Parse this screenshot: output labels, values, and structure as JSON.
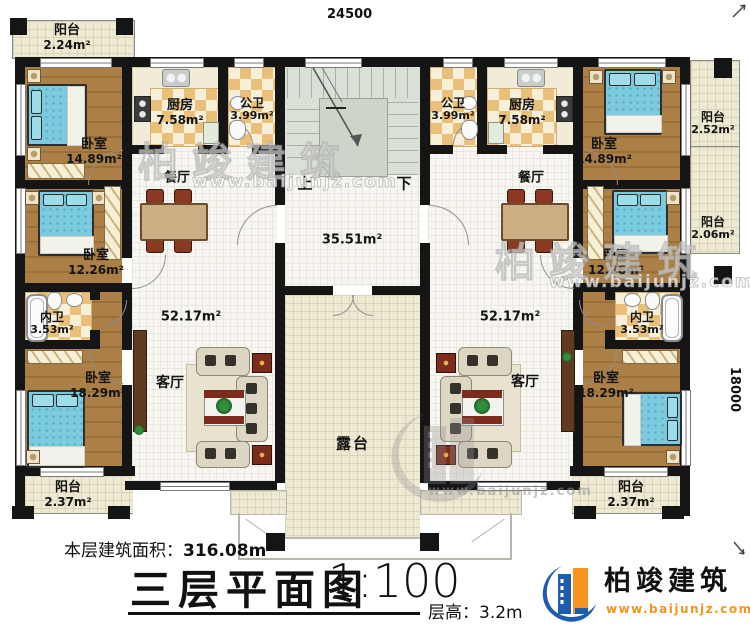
{
  "dims": {
    "top": "24500",
    "right": "18000"
  },
  "stairs": {
    "up": "上",
    "down": "下"
  },
  "rooms": {
    "tl_balcony": {
      "name": "阳台",
      "area": "2.24m²"
    },
    "l_bedroom1": {
      "name": "卧室",
      "area": "14.89m²"
    },
    "l_kitchen": {
      "name": "厨房",
      "area": "7.58m²"
    },
    "l_bath": {
      "name": "公卫",
      "area": "3.99m²"
    },
    "l_dining": {
      "name": "餐厅"
    },
    "l_bedroom2": {
      "name": "卧室",
      "area": "12.26m²"
    },
    "l_wc": {
      "name": "内卫",
      "area": "3.53m²"
    },
    "l_bedroom3": {
      "name": "卧室",
      "area": "18.29m²"
    },
    "l_living": {
      "name": "客厅",
      "area": "52.17m²"
    },
    "l_balcony_b": {
      "name": "阳台",
      "area": "2.37m²"
    },
    "hall": {
      "area": "35.51m²"
    },
    "terrace": {
      "name": "露台"
    },
    "r_bath": {
      "name": "公卫",
      "area": "3.99m²"
    },
    "r_kitchen": {
      "name": "厨房",
      "area": "7.58m²"
    },
    "r_dining": {
      "name": "餐厅"
    },
    "r_bedroom1": {
      "name": "卧室",
      "area": "14.89m²"
    },
    "r_balcony1": {
      "name": "阳台",
      "area": "2.52m²"
    },
    "r_balcony2": {
      "name": "阳台",
      "area": "2.06m²"
    },
    "r_bedroom2": {
      "name": "卧室",
      "area": "12.26m²"
    },
    "r_wc": {
      "name": "内卫",
      "area": "3.53m²"
    },
    "r_bedroom3": {
      "name": "卧室",
      "area": "18.29m²"
    },
    "r_living": {
      "name": "客厅",
      "area": "52.17m²"
    },
    "r_balcony_b": {
      "name": "阳台",
      "area": "2.37m²"
    }
  },
  "footer": {
    "area_label": "本层建筑面积：",
    "area_value": "316.08m²",
    "title": "三层平面图",
    "scale": "1:100",
    "height_label": "层高：",
    "height_value": "3.2m"
  },
  "brand": {
    "name": "柏竣建筑",
    "url": "www.baijunjz.com"
  },
  "colors": {
    "wall": "#151515",
    "brand_blue": "#1e5cad",
    "brand_orange": "#f7941e",
    "bed": "#7ccadd",
    "wood": "#a97d42",
    "checker": "#e9c079",
    "stair": "#d9e0d6",
    "terrace": "#ece7d1"
  }
}
